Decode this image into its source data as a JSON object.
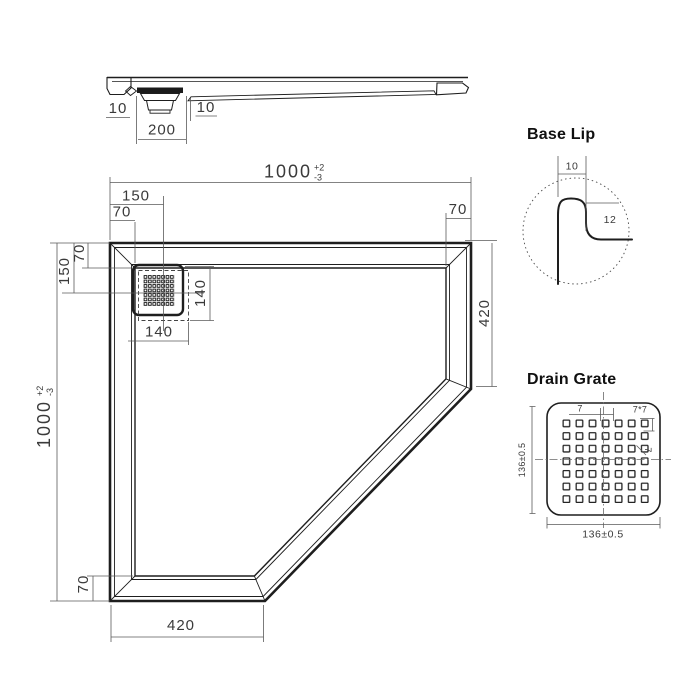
{
  "colors": {
    "background": "#ffffff",
    "drawing_ink": "#1e1e1e",
    "dimension_lines": "#5b5b5b",
    "dimension_text": "#3a3a3a"
  },
  "cross_section": {
    "dim_left_lip": "10",
    "dim_drain_width": "200",
    "dim_right_lip": "10"
  },
  "plan": {
    "dim_width": {
      "value": "1000",
      "tol_plus": "+2",
      "tol_minus": "-3"
    },
    "dim_height": {
      "value": "1000",
      "tol_plus": "+2",
      "tol_minus": "-3"
    },
    "dim_drain_offset_x": "150",
    "dim_rim_top_left": "70",
    "dim_rim_top_right": "70",
    "dim_drain_offset_y": "150",
    "dim_rim_left": "70",
    "dim_drain_width": "140",
    "dim_drain_height": "140",
    "dim_right_edge": "420",
    "dim_rim_bottom": "70",
    "dim_bottom_edge": "420"
  },
  "base_lip": {
    "title": "Base Lip",
    "dim_width": "10",
    "dim_height": "12"
  },
  "drain_grate": {
    "title": "Drain Grate",
    "dim_pitch": "7",
    "dim_grid": "7*7",
    "dim_square": "7",
    "dim_width": "136±0.5",
    "dim_height": "136±0.5"
  }
}
